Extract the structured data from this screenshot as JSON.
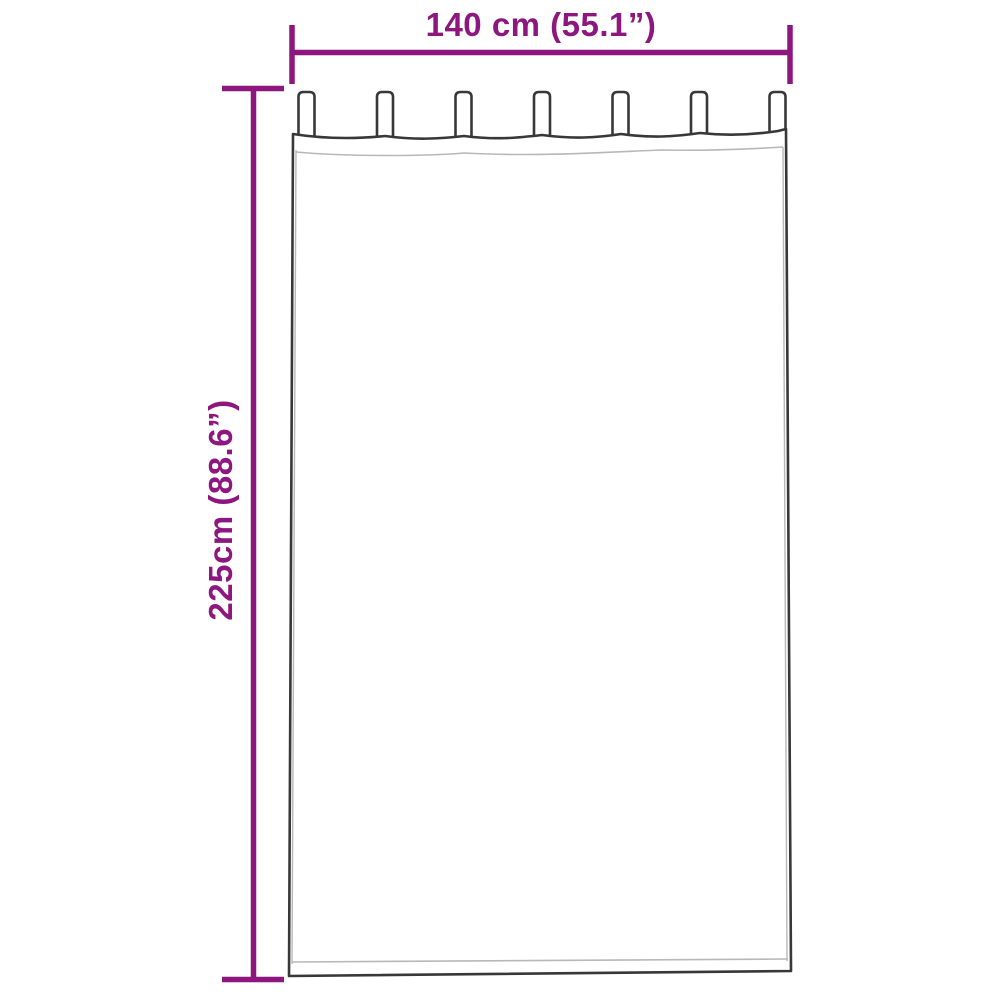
{
  "diagram": {
    "type": "product-dimension-diagram",
    "product": "tab-top-curtain",
    "width_label": "140 cm (55.1”)",
    "height_label": "225cm (88.6”)",
    "tab_count": 7,
    "colors": {
      "dimension": "#8e177f",
      "outline": "#383838",
      "hem_line": "#b8b8b8",
      "background": "#ffffff"
    }
  }
}
